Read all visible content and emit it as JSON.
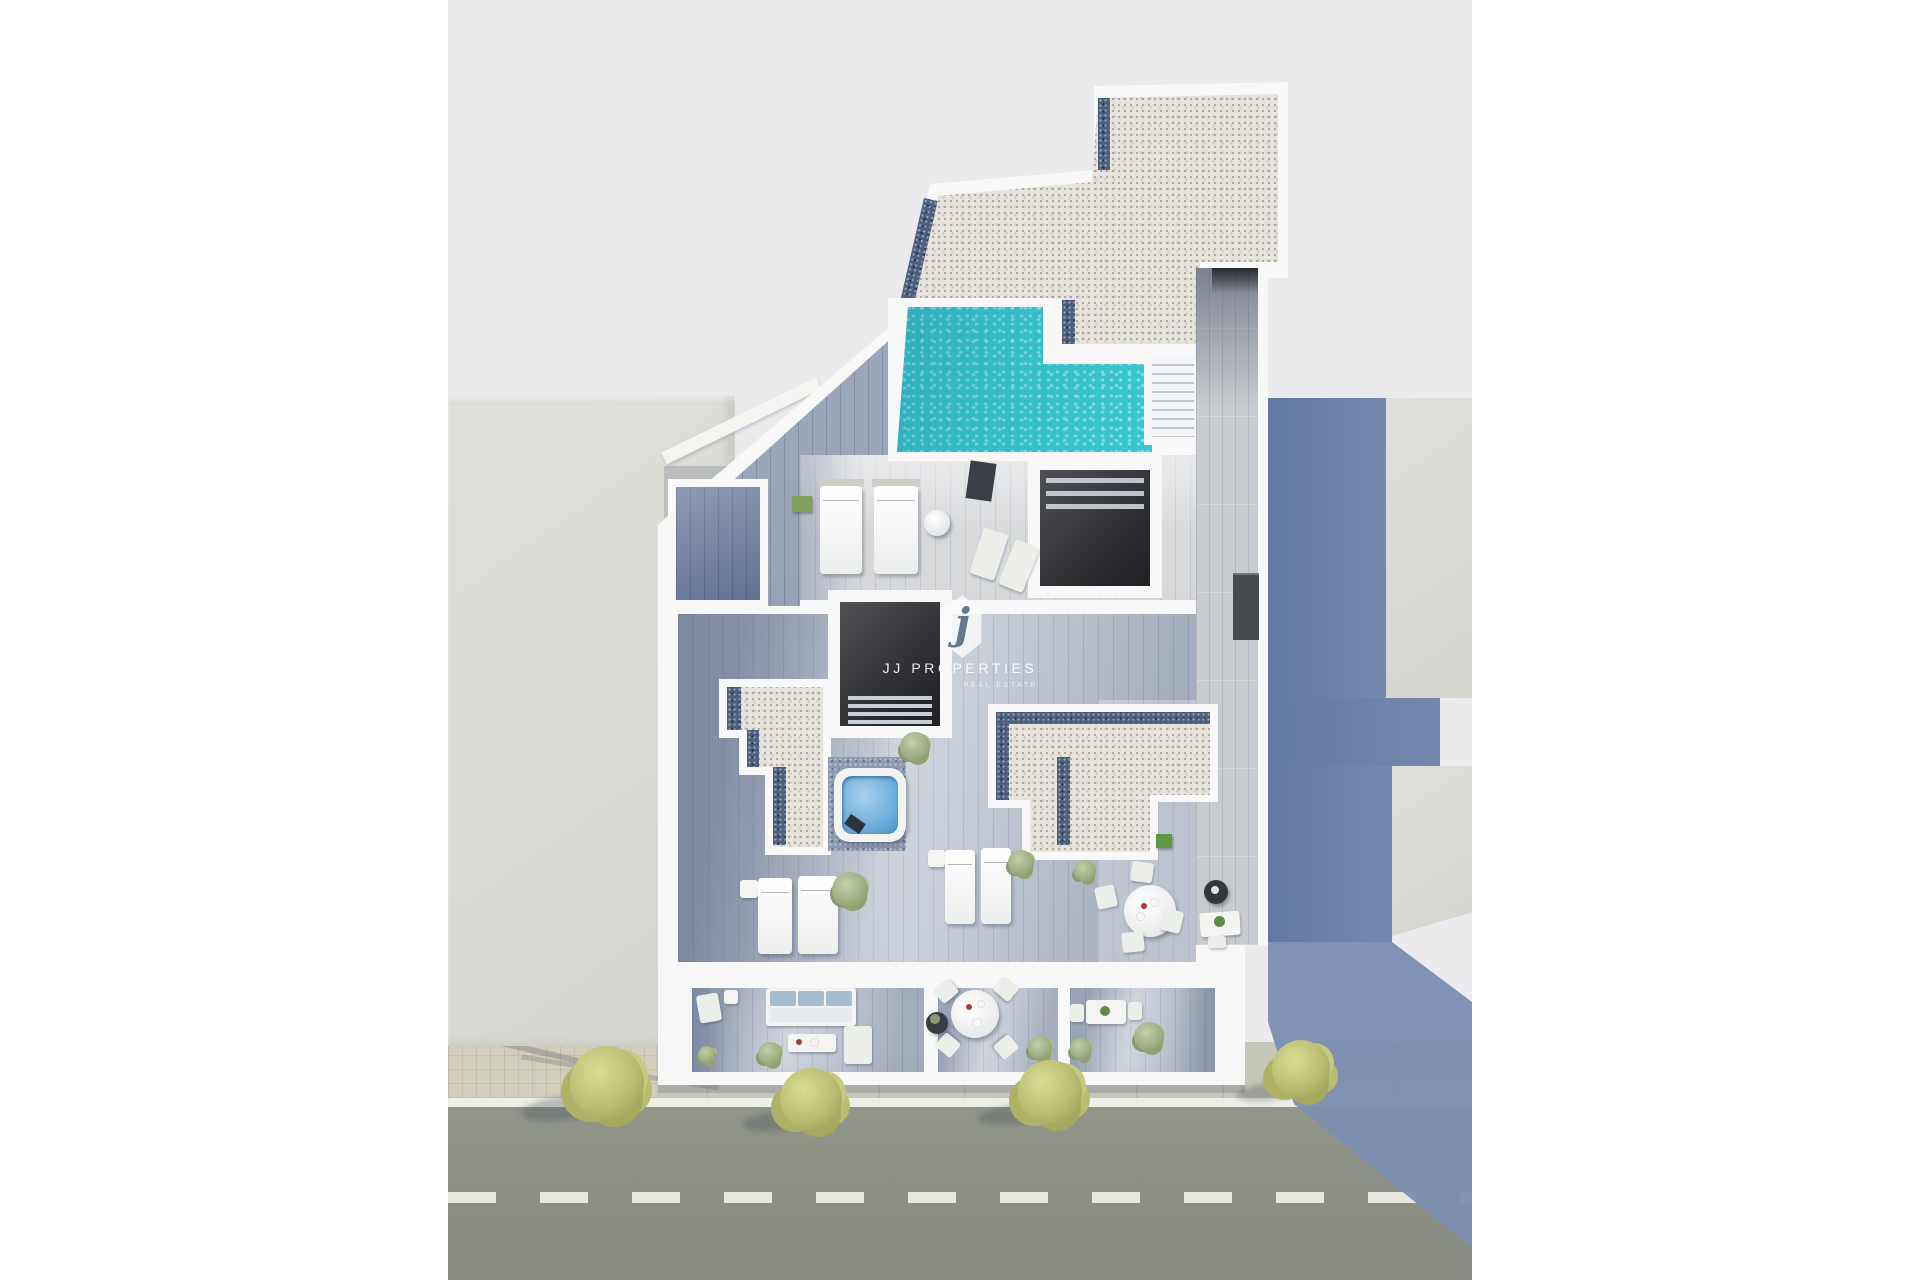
{
  "scene": {
    "type": "aerial-3d-architectural-render",
    "subject": "penthouse roof-terrace floor plan with pool, jacuzzi, terraces and street",
    "watermark": {
      "badge_letter": "j",
      "title": "JJ PROPERTIES",
      "subtitle": "REAL ESTATE"
    },
    "objects": [
      "rooftop-pool",
      "pool-stairs",
      "roof-gravel-terrace",
      "wood-deck-walkway",
      "stair-void",
      "patio-void",
      "jacuzzi",
      "gravel-planter-left",
      "gravel-planter-right",
      "sun-beds",
      "sun-loungers",
      "dining-table-round",
      "balcony-sofa",
      "balcony-dining-table",
      "balcony-bistro-table",
      "street",
      "sidewalk",
      "street-trees",
      "neighbor-building-left",
      "neighbor-building-right",
      "cast-shadow"
    ]
  },
  "palette": {
    "background": "#ffffff",
    "ground": "#ebebed",
    "street": "#8f9388",
    "road-line": "#edefe6",
    "sidewalk": "#c6c6b9",
    "neighbor-building": "#dcdcd6",
    "building": "#f7f8f7",
    "pool": "#2fcad4",
    "pool-shadow": "#0b3f66",
    "wood-sunlit": "#d7d9db",
    "wood-shaded": "#93a0b6",
    "deck": "#c9cccf",
    "gravel-light": "#e7e4dd",
    "gravel-dark": "#4e5f7d",
    "shadow-blue": "#6881ac",
    "dark-interior": "#2e2f32",
    "tree": "#b9bd72",
    "bush": "#9cab7f",
    "jacuzzi-water": "#6fb0de",
    "sofa-cushion": "#a8bccf",
    "watermark-text": "#ffffff"
  }
}
